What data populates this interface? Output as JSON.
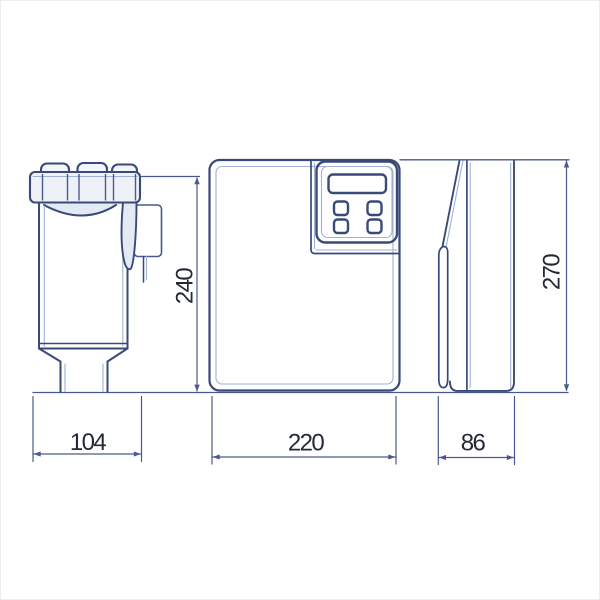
{
  "drawing": {
    "dimensions": {
      "container_width": "104",
      "container_height": "240",
      "cabinet_width": "220",
      "cabinet_height": "270",
      "cabinet_depth": "86"
    },
    "colors": {
      "line": "#3a4a78",
      "line_light": "#9fb2d2",
      "dimension_line": "#4a5a8c",
      "text": "#232936",
      "background": "#ffffff"
    }
  }
}
